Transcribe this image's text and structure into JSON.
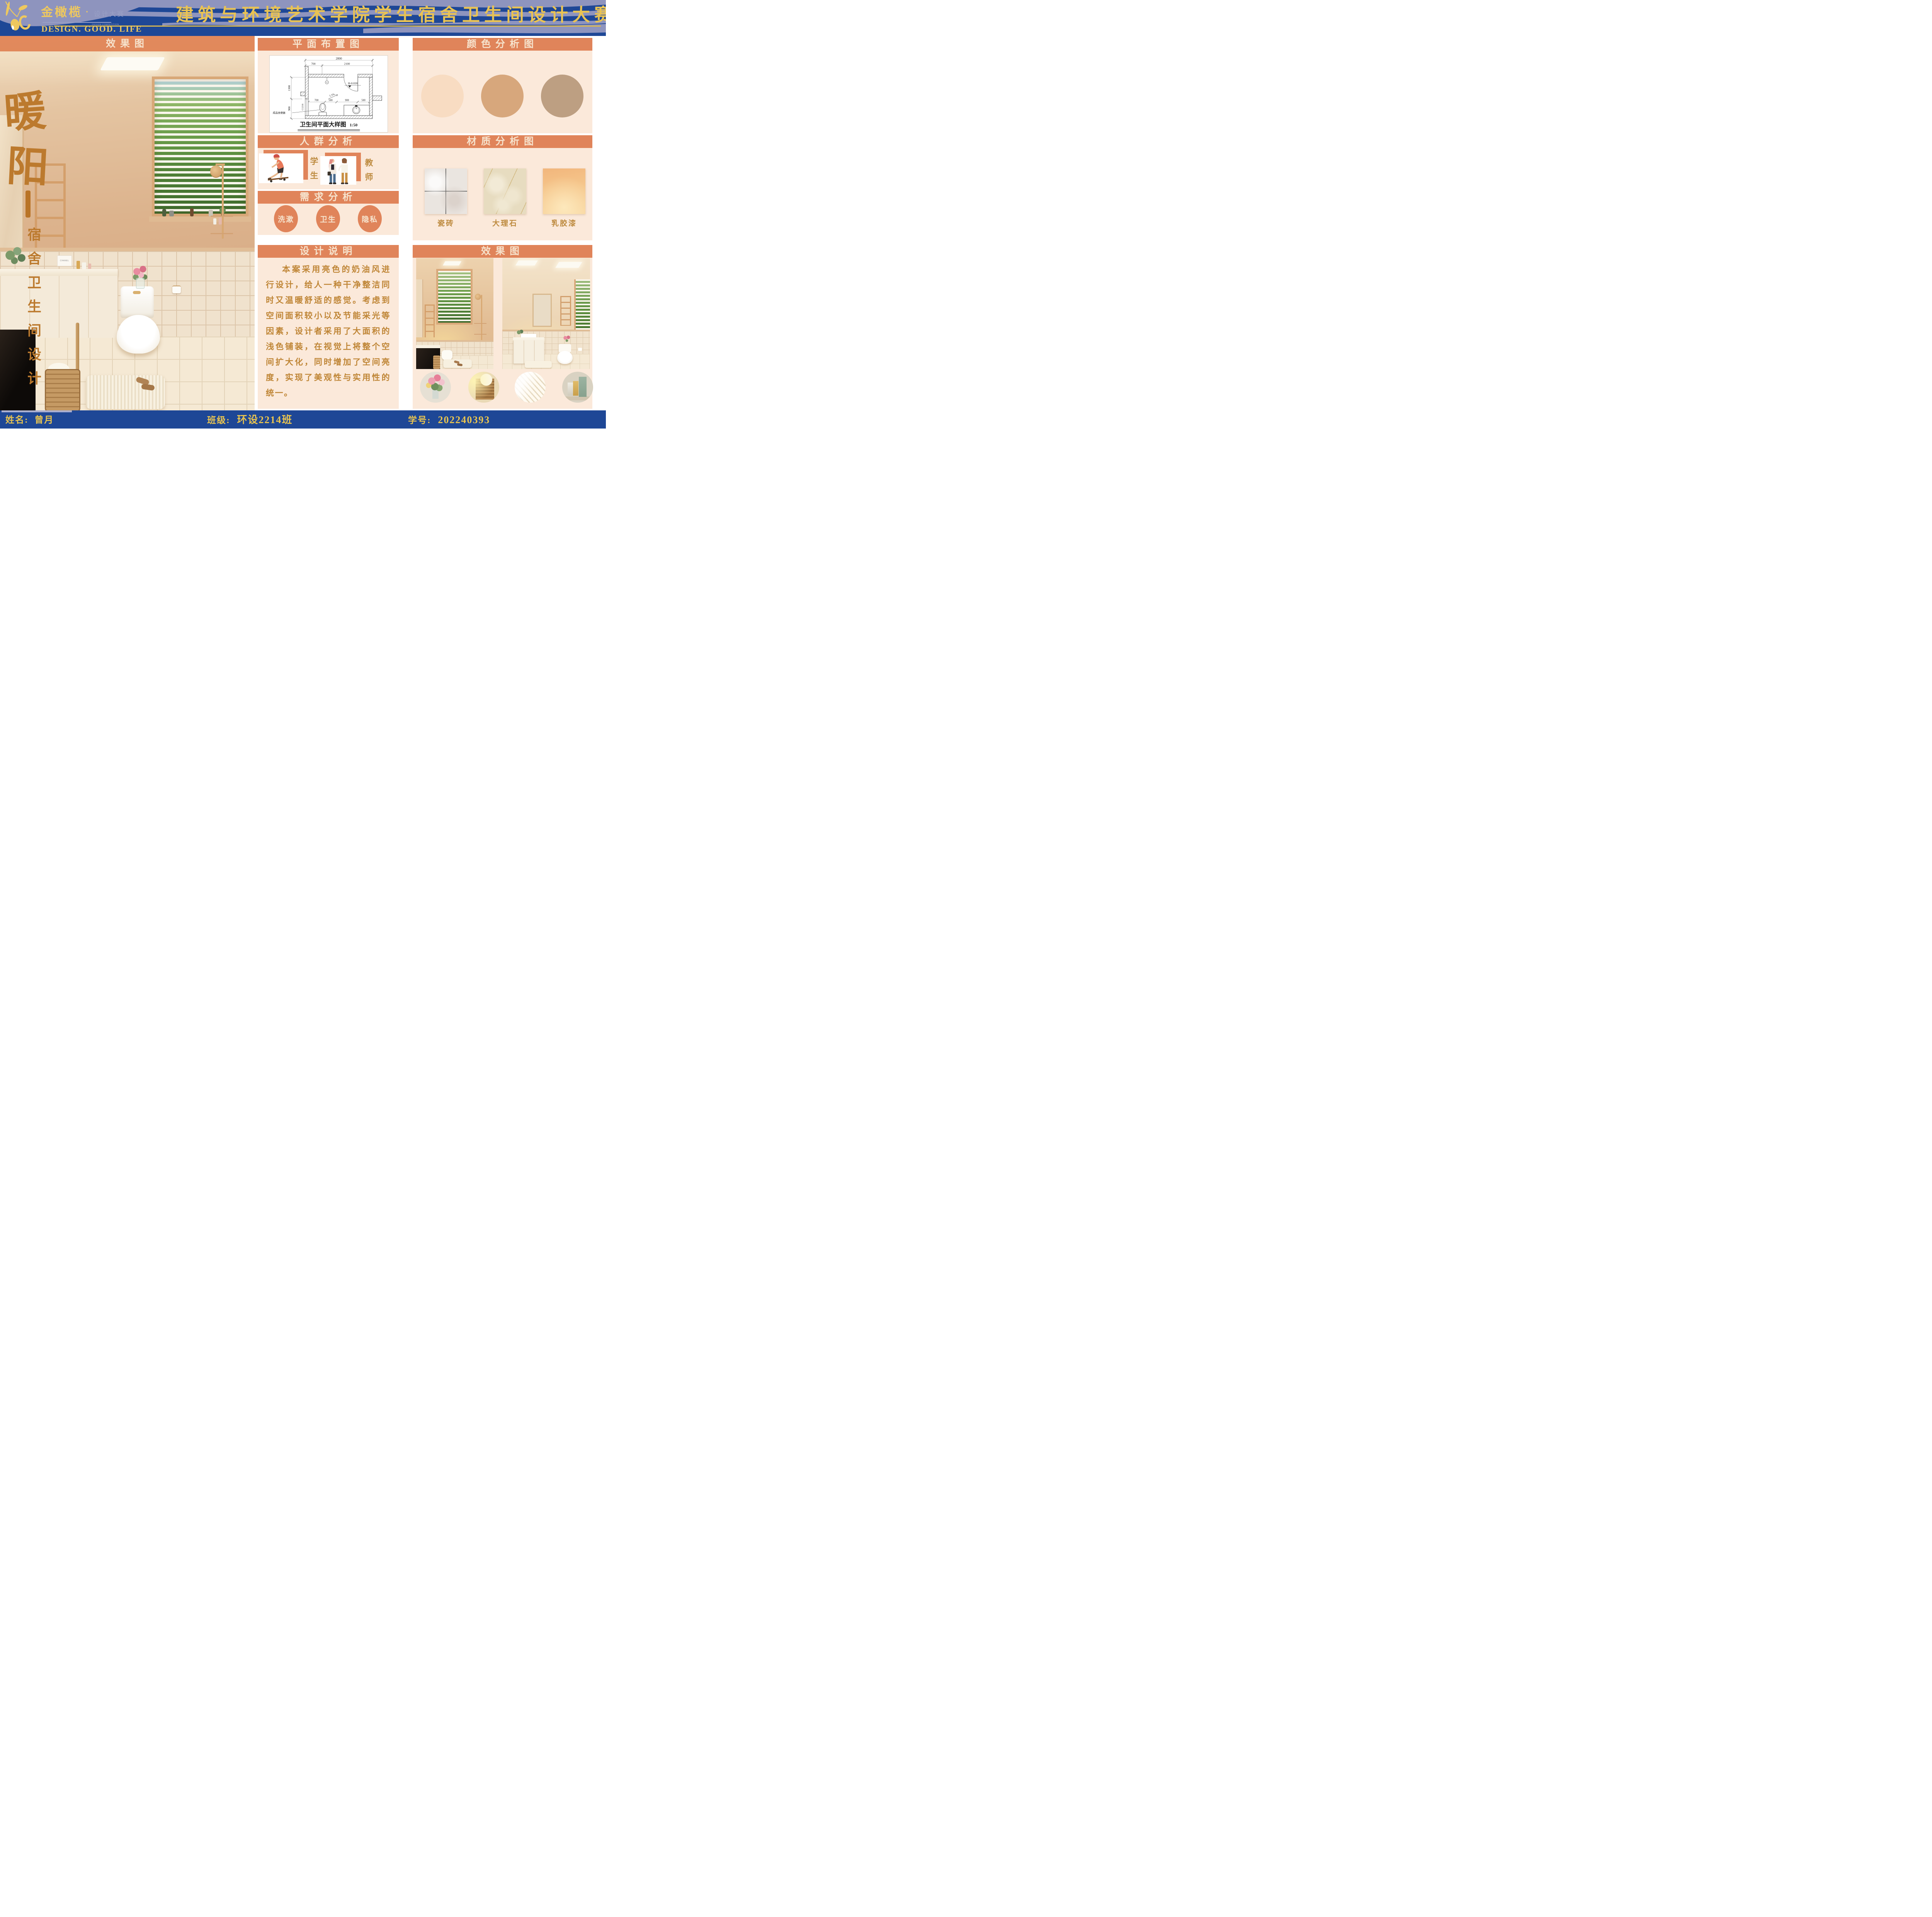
{
  "header": {
    "logo": {
      "name_cn": "金橄榄",
      "dot": "·",
      "sub_cn": "设计大赛",
      "sub_en": "DESIGN COMPETITION",
      "tagline": "DESIGN. GOOD. LIFE"
    },
    "title": "建筑与环境艺术学院学生宿舍卫生间设计大赛"
  },
  "hero": {
    "header": "效果图",
    "chars": [
      "暖",
      "阳"
    ],
    "subtitle": "宿舍卫生间设计",
    "brand": "CHANEL"
  },
  "middle": {
    "plan": {
      "header": "平面布置图",
      "caption": "卫生间平面大样图",
      "scale": "1:50",
      "dims": {
        "total": "2800",
        "d700": "700",
        "d2100": "2100",
        "d1300": "1300",
        "d900": "900",
        "s700": "700",
        "s500a": "500",
        "s900": "900",
        "s500b": "500",
        "slope": "1.5%",
        "level": "H-0.020",
        "window": "C1216",
        "toilet_label": "成品坐便器"
      }
    },
    "crowd": {
      "header": "人群分析",
      "items": [
        {
          "label": "学生"
        },
        {
          "label": "教师"
        }
      ]
    },
    "demand": {
      "header": "需求分析",
      "items": [
        {
          "label": "洗漱"
        },
        {
          "label": "卫生"
        },
        {
          "label": "隐私"
        }
      ]
    },
    "desc": {
      "header": "设计说明",
      "text": "本案采用亮色的奶油风进行设计，给人一种干净整洁同时又温暖舒适的感觉。考虑到空间面积较小以及节能采光等因素，设计者采用了大面积的浅色铺装，在视觉上将整个空间扩大化，同时增加了空间亮度，实现了美观性与实用性的统一。"
    }
  },
  "right": {
    "colors": {
      "header": "颜色分析图",
      "swatches": [
        {
          "hex": "#f8dcc2"
        },
        {
          "hex": "#d7a77c"
        },
        {
          "hex": "#bd9f82"
        }
      ]
    },
    "materials": {
      "header": "材质分析图",
      "items": [
        {
          "label": "瓷砖"
        },
        {
          "label": "大理石"
        },
        {
          "label": "乳胶漆"
        }
      ]
    },
    "renders": {
      "header": "效果图"
    }
  },
  "footer": {
    "name_label": "姓名:",
    "name_value": "曾月",
    "class_label": "班级:",
    "class_value": "环设2214班",
    "id_label": "学号:",
    "id_value": "202240393"
  }
}
